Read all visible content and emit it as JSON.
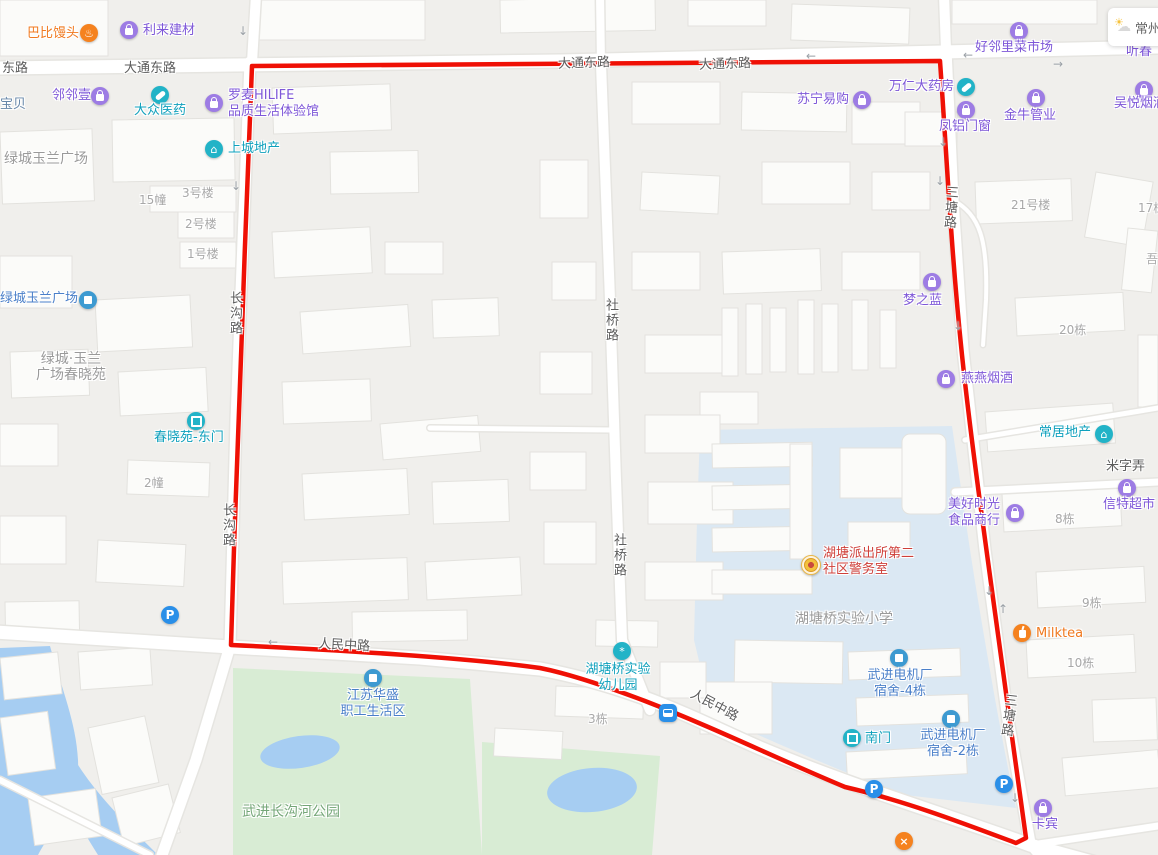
{
  "weather": {
    "city": "常州",
    "partial_poi": "听春"
  },
  "roads": {
    "donglu": "东路",
    "datong_dong_lu": "大通东路",
    "changgou_lu": "长沟路",
    "sheqiao_lu": "社桥路",
    "santang_lu": "三塘路",
    "renmin_zhong_lu": "人民中路",
    "mizi_nong": "米字弄"
  },
  "areas": {
    "school": "湖塘桥实验小学",
    "park": "武进长沟河公园",
    "lvcheng_plaza_north": "绿城玉兰广场",
    "lvcheng_plaza_west": "绿城玉兰广场",
    "chunxiao_line1": "绿城·玉兰",
    "chunxiao_line2": "广场春晓苑"
  },
  "pois": {
    "babi_mantou": "巴比馒头",
    "lilai_jiancai": "利来建材",
    "linlin_yi": "邻邻壹",
    "baobei": "宝贝",
    "dazhong_yiyao": "大众医药",
    "luomai_line1": "罗麦HILIFE",
    "luomai_line2": "品质生活体验馆",
    "shangcheng_dichan": "上城地产",
    "chunxiaoyuan_dongmen": "春晓苑-东门",
    "suning": "苏宁易购",
    "wanren_dayaofang": "万仁大药房",
    "fenglv_menchuang": "凤铝门窗",
    "haolinli_market": "好邻里菜市场",
    "jinniu_guanye": "金牛管业",
    "wuyue_yanjiu": "吴悦烟酒",
    "mengzhilan": "梦之蓝",
    "yanyan_yanjiu": "燕燕烟酒",
    "changju_dichan": "常居地产",
    "meihao_line1": "美好时光",
    "meihao_line2": "食品商行",
    "xinte_chaoshi": "信特超市",
    "milktea": "Milktea",
    "kabin": "卡宾",
    "police_line1": "湖塘派出所第二",
    "police_line2": "社区警务室",
    "kindergarten_line1": "湖塘桥实验",
    "kindergarten_line2": "幼儿园",
    "motor_dorm4_line1": "武进电机厂",
    "motor_dorm4_line2": "宿舍-4栋",
    "motor_dorm2_line1": "武进电机厂",
    "motor_dorm2_line2": "宿舍-2栋",
    "nanmen": "南门",
    "jiangsu_line1": "江苏华盛",
    "jiangsu_line2": "职工生活区"
  },
  "buildings": {
    "no3": "3号楼",
    "b15": "15幢",
    "no2": "2号楼",
    "no1": "1号楼",
    "b2": "2幢",
    "no21": "21号楼",
    "b17": "17栋",
    "wu": "吾",
    "b20": "20栋",
    "b8": "8栋",
    "b9": "9栋",
    "b10": "10栋",
    "b3": "3栋"
  },
  "icons": {
    "home": "⌂",
    "steam": "♨",
    "utensils": "×",
    "flower": "*",
    "parking": "P",
    "arrow_down": "↓",
    "arrow_up": "↑",
    "arrow_left": "←",
    "arrow_right": "→",
    "sun": "☀",
    "cloud": "☁"
  },
  "colors": {
    "boundary": "#ef1005",
    "poi_purple": "#7e57d8",
    "poi_teal": "#0ea0bc",
    "poi_blue": "#4a7fc9",
    "poi_red": "#cf3f39",
    "poi_orange": "#f0791f",
    "label_green": "#74a677",
    "water": "#a6cdf2",
    "park": "#d8ecd4",
    "campus": "#dbe8f3",
    "road_fill": "#ffffff"
  }
}
